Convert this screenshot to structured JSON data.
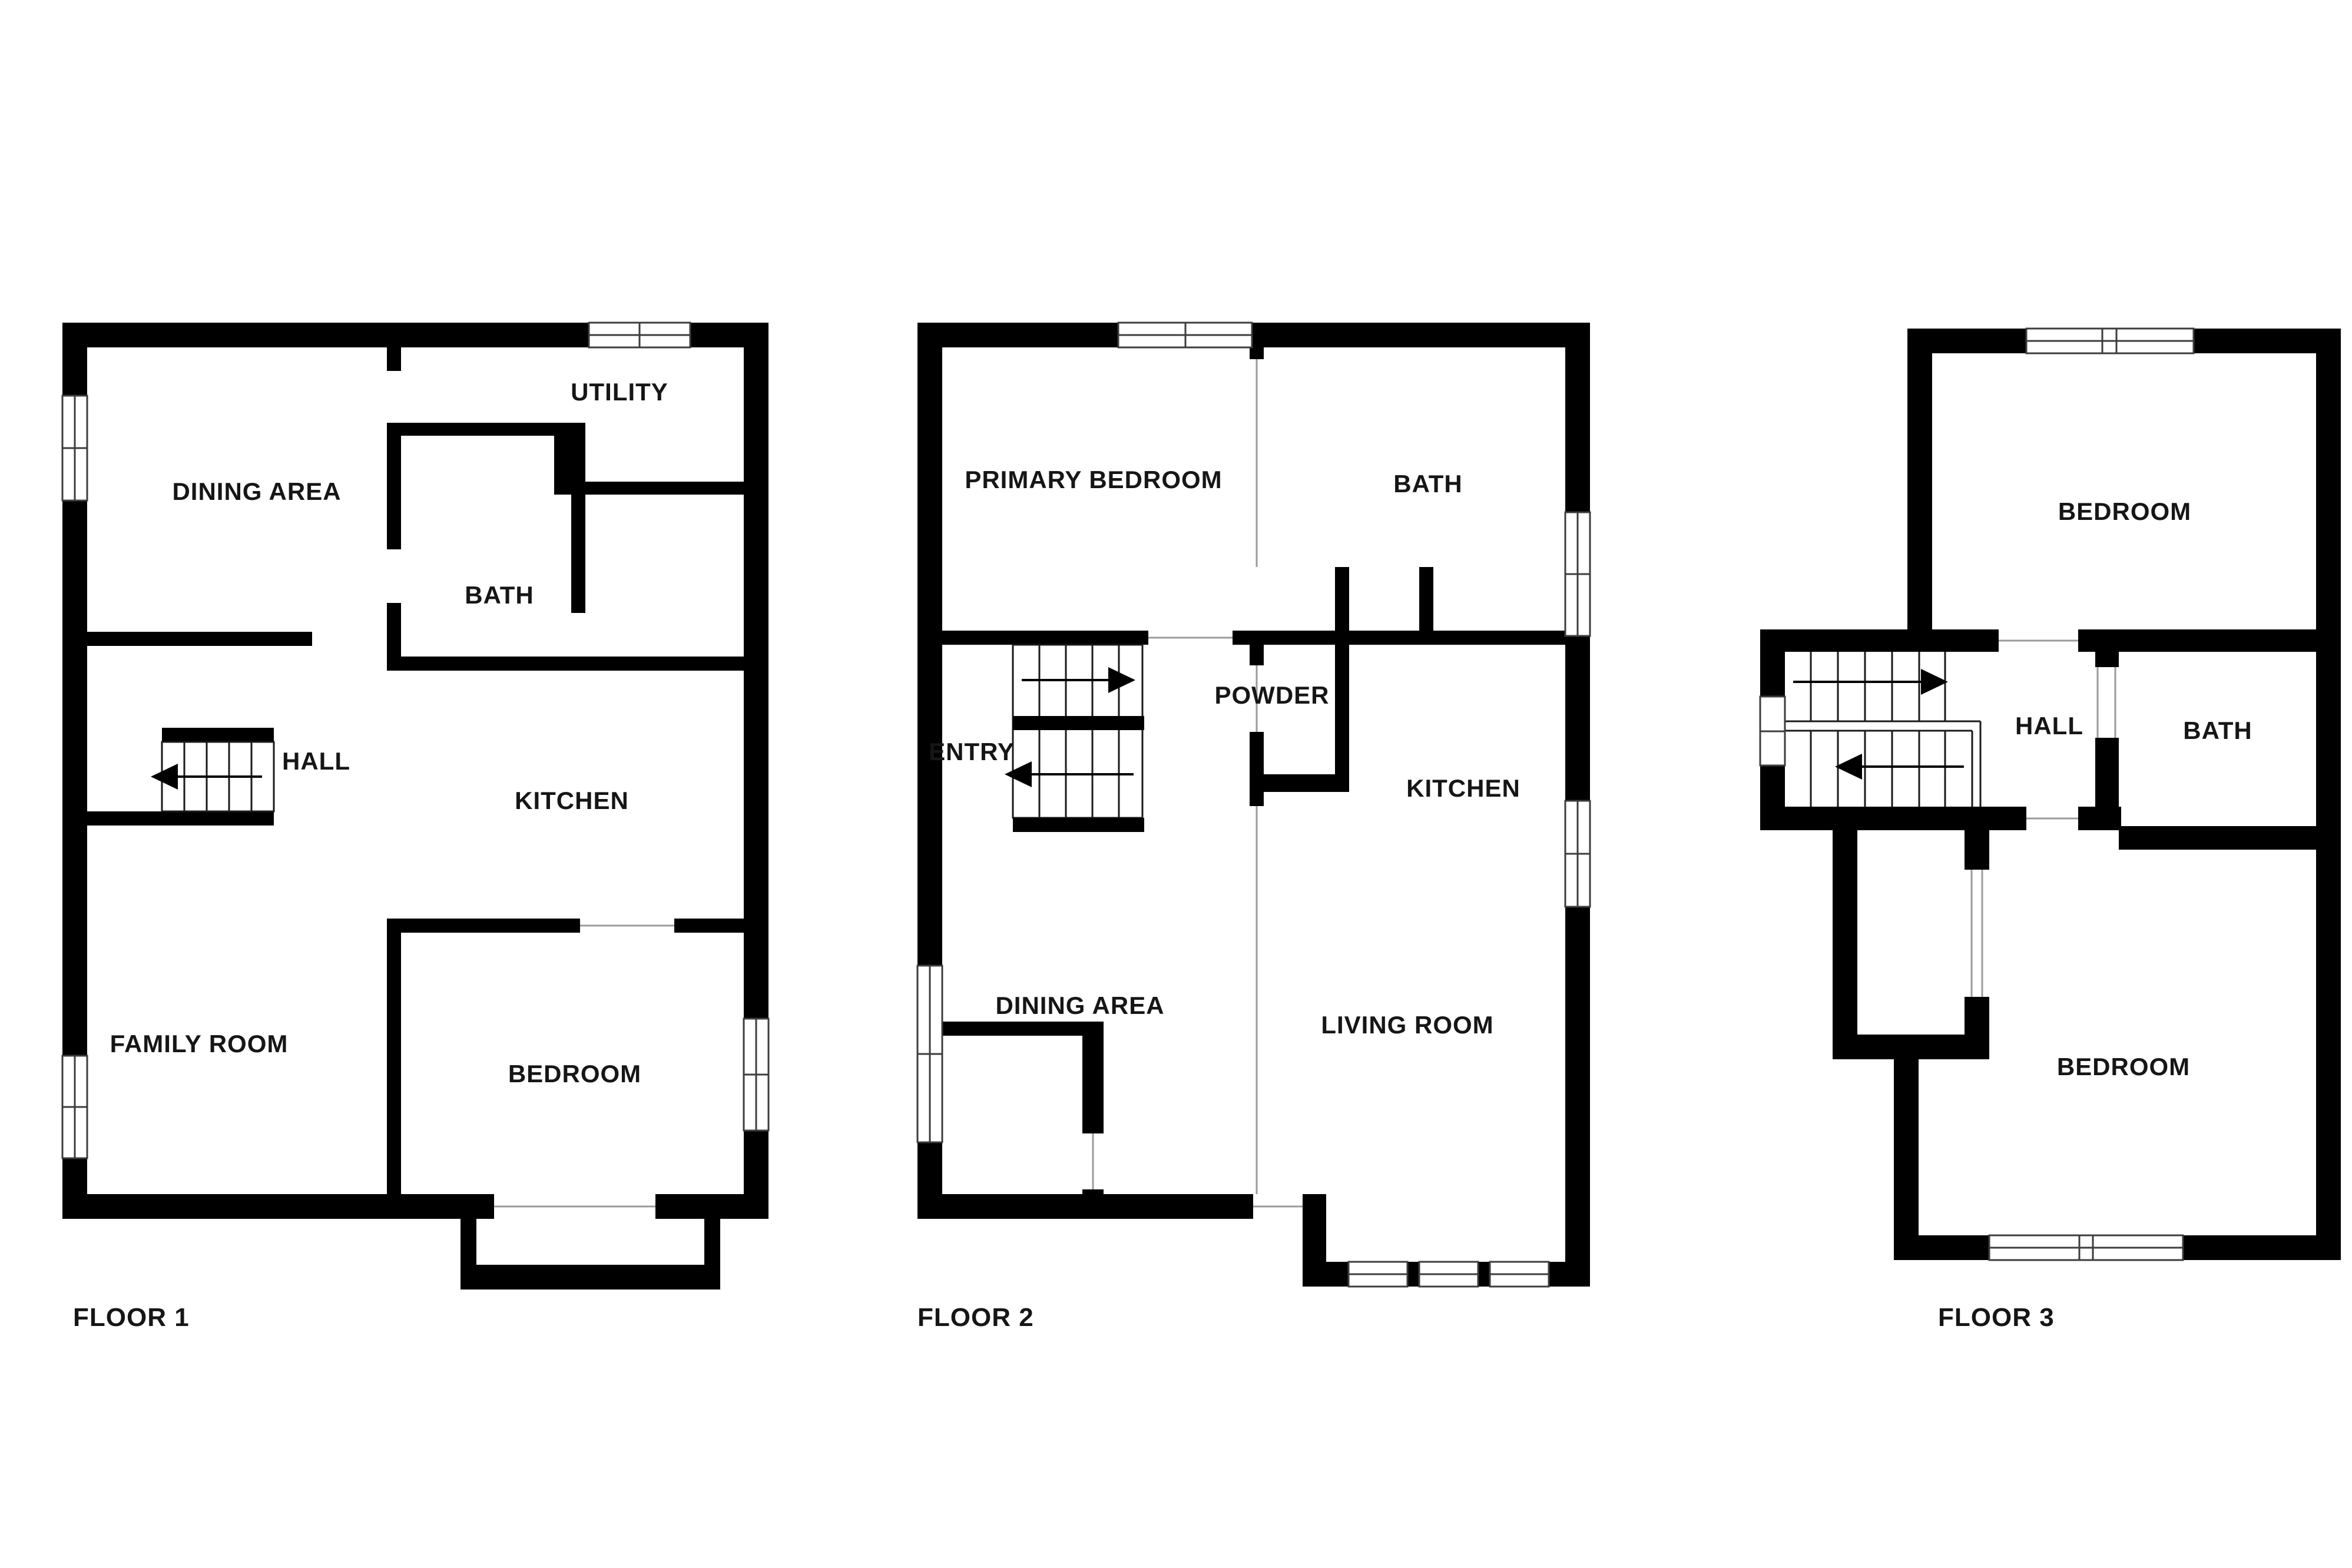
{
  "document": {
    "type": "floor-plan",
    "background": "#ffffff"
  },
  "colors": {
    "wall": "#000000",
    "label_text": "#161616",
    "thin_line": "#9b9b9b",
    "window_frame": "#3d3d3d"
  },
  "floors": [
    {
      "label": "FLOOR 1",
      "rooms": [
        {
          "name": "DINING AREA"
        },
        {
          "name": "UTILITY"
        },
        {
          "name": "BATH"
        },
        {
          "name": "HALL"
        },
        {
          "name": "KITCHEN"
        },
        {
          "name": "FAMILY ROOM"
        },
        {
          "name": "BEDROOM"
        }
      ]
    },
    {
      "label": "FLOOR 2",
      "rooms": [
        {
          "name": "PRIMARY BEDROOM"
        },
        {
          "name": "BATH"
        },
        {
          "name": "ENTRY"
        },
        {
          "name": "POWDER"
        },
        {
          "name": "KITCHEN"
        },
        {
          "name": "DINING AREA"
        },
        {
          "name": "LIVING ROOM"
        }
      ]
    },
    {
      "label": "FLOOR 3",
      "rooms": [
        {
          "name": "BEDROOM"
        },
        {
          "name": "HALL"
        },
        {
          "name": "BATH"
        },
        {
          "name": "BEDROOM"
        }
      ]
    }
  ]
}
